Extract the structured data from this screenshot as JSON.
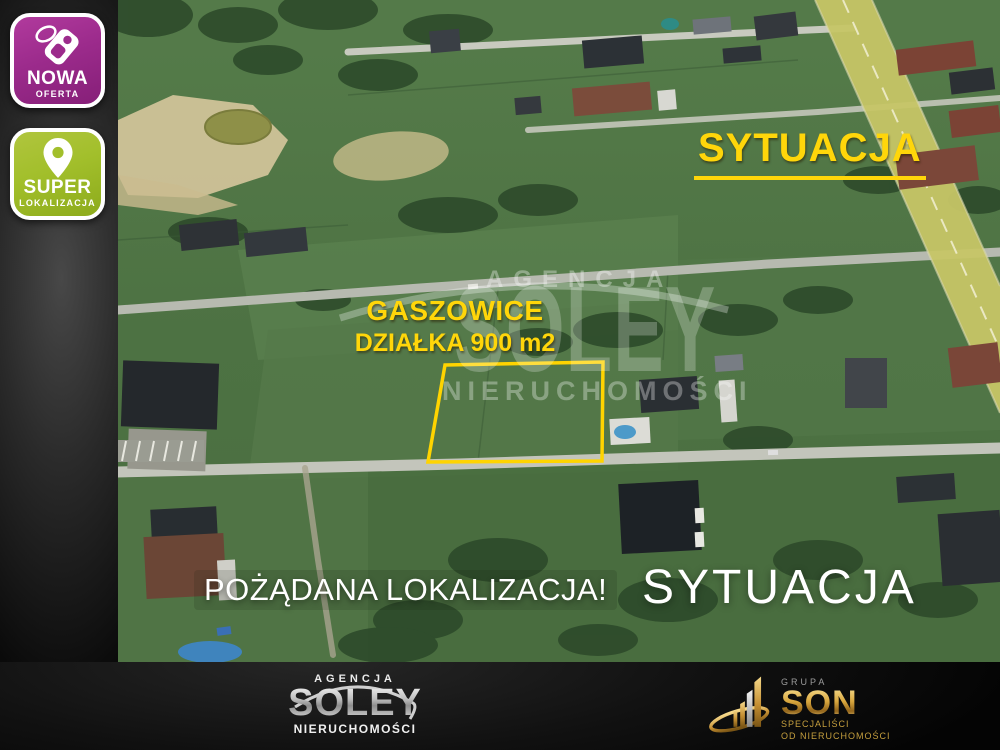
{
  "badges": {
    "new_offer": {
      "line1": "NOWA",
      "line2": "OFERTA",
      "icon": "price-tag-icon",
      "color": "#9c2b8c"
    },
    "super_location": {
      "line1": "SUPER",
      "line2": "LOKALIZACJA",
      "icon": "location-pin-icon",
      "color": "#a2bf2b"
    }
  },
  "map": {
    "situation_label_top": "SYTUACJA",
    "situation_label_bottom": "SYTUACJA",
    "plot": {
      "town": "GASZOWICE",
      "area": "DZIAŁKA 900 m2",
      "outline_color": "#ffd400"
    },
    "caption": "POŻĄDANA LOKALIZACJA!",
    "watermark": {
      "line1": "AGENCJA",
      "line2": "SOLEY",
      "line3": "NIERUCHOMOŚCI"
    }
  },
  "footer": {
    "soley_logo": {
      "top": "AGENCJA",
      "name": "SOLEY",
      "bottom": "NIERUCHOMOŚCI"
    },
    "son_logo": {
      "group": "GRUPA",
      "name": "SON",
      "tagline1": "SPECJALIŚCI",
      "tagline2": "OD NIERUCHOMOŚCI",
      "icon": "building-bars-icon"
    }
  },
  "colors": {
    "accent_yellow": "#ffd60a",
    "badge_magenta": "#9c2b8c",
    "badge_green": "#a2bf2b",
    "plot_outline": "#ffd400",
    "son_gold": "#d9a73e"
  }
}
